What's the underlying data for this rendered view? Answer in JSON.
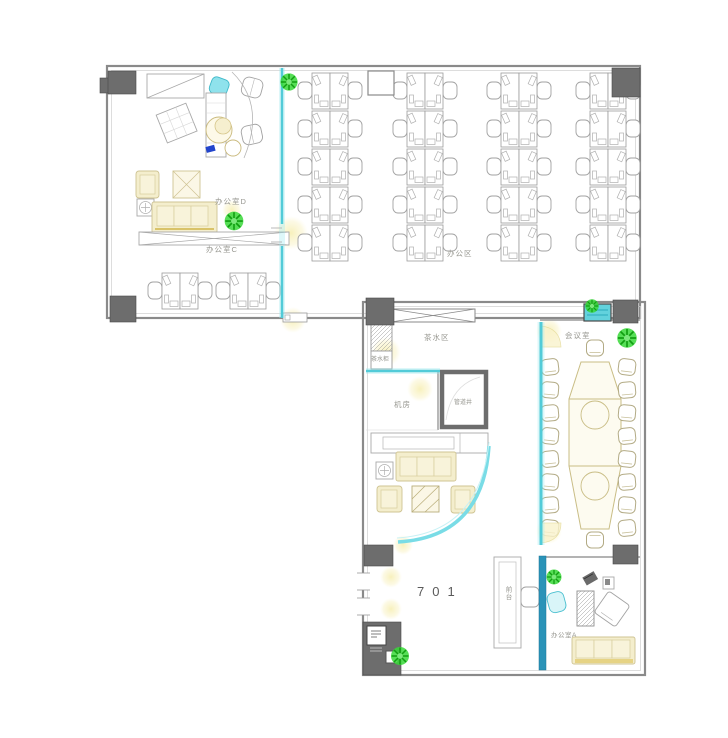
{
  "plan": {
    "unit_number": "701",
    "rooms": {
      "office_d": "办公室D",
      "office_c": "办公室C",
      "open_office": "办公区",
      "tea_area": "茶水区",
      "tea_cabinet": "茶水柜",
      "machine_room": "机房",
      "pipe_shaft": "管道井",
      "meeting_room": "会议室",
      "reception_desk": "前台",
      "office_a": "办公室A"
    },
    "counts": {
      "open_office_workstations": 40,
      "office_c_workstations": 4,
      "meeting_room_seats": 18,
      "plants": 6
    },
    "colors": {
      "wall": "#8a8a8a",
      "column": "#6d6d6d",
      "glass_partition": "#52cbd8",
      "dark_glass_partition": "#2a93b8",
      "sofa_cream": "#f4eecd",
      "plant_green": "#38d838",
      "light_glow": "#f6eeb0"
    }
  }
}
